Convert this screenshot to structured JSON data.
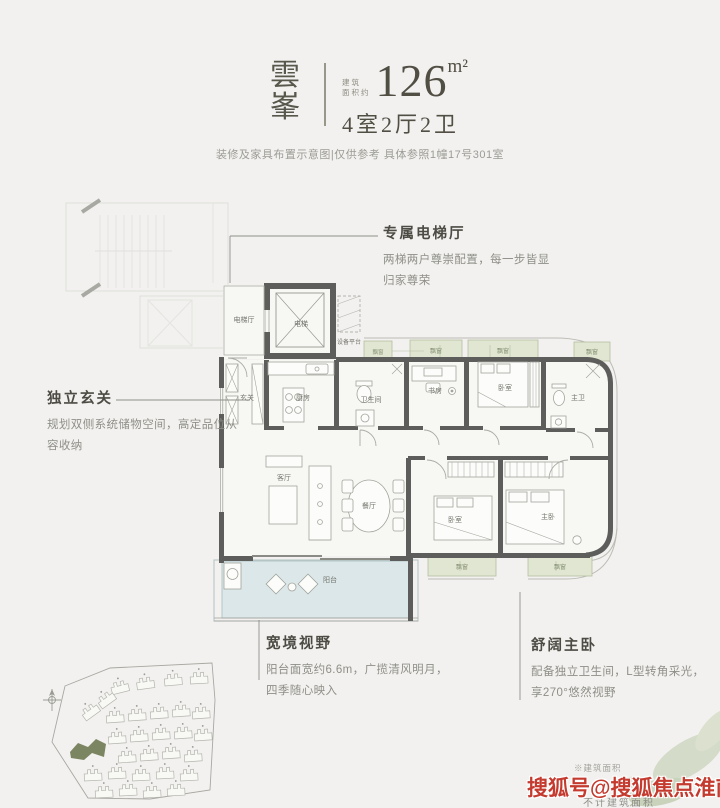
{
  "page": {
    "background": "#f2f1ef"
  },
  "header": {
    "name_char_1": "雲",
    "name_char_2": "峯",
    "area_label_line1": "建筑",
    "area_label_line2": "面积约",
    "area_value": "126",
    "area_unit": "m²",
    "layout": "4室2厅2卫",
    "disclaimer": "装修及家具布置示意图|仅供参考 具体参照1幢17号301室"
  },
  "annotations": {
    "elevator": {
      "title": "专属电梯厅",
      "line1": "两梯两户尊崇配置，每一步皆显",
      "line2": "归家尊荣"
    },
    "foyer": {
      "title": "独立玄关",
      "line1": "规划双侧系统储物空间，高定品位从",
      "line2": "容收纳"
    },
    "view": {
      "title": "宽境视野",
      "line1": "阳台面宽约6.6m，广揽清风明月，",
      "line2": "四季随心映入"
    },
    "master": {
      "title": "舒阔主卧",
      "line1": "配备独立卫生间，L型转角采光，",
      "line2": "享270°悠然视野"
    }
  },
  "floorplan": {
    "rooms": {
      "elevator_hall": "电梯厅",
      "elevator": "电梯",
      "equipment_platform": "设备平台",
      "foyer": "玄关",
      "kitchen": "厨房",
      "bathroom": "卫生间",
      "study": "书房",
      "bedroom": "卧室",
      "master_bedroom": "主卧",
      "master_bathroom": "主卫",
      "living_room": "客厅",
      "dining_room": "餐厅",
      "balcony": "阳台",
      "bay_window": "飘窗"
    },
    "colors": {
      "wall": "#5d5d5b",
      "bay_window_fill": "#e0e6d2",
      "balcony_fill": "#dbe7e8",
      "highlight_building": "#7b8562"
    }
  },
  "watermark": {
    "note_top": "※建筑面积",
    "text": "搜狐号@搜狐焦点淮南站",
    "note_bottom": "不计建筑面积",
    "color": "#c43a2e"
  }
}
